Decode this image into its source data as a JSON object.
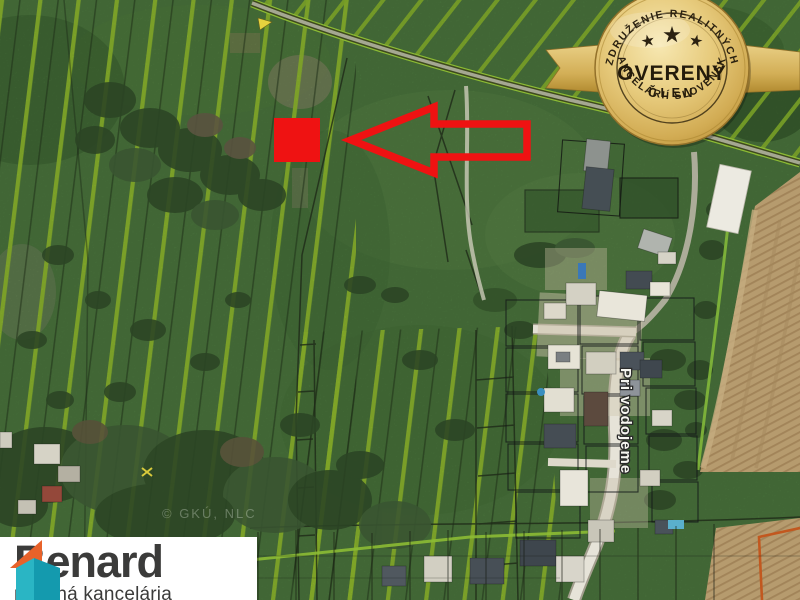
{
  "map": {
    "street_label": "Pri vodojeme",
    "watermark": "© GKÚ, NLC"
  },
  "badge": {
    "top_arc": "ZDRUŽENIE REALITNÝCH",
    "word": "OVERENÝ",
    "sub": "ČLEN",
    "bottom_arc": "KANCELÁRIÍ SLOVENSKA",
    "stars": 3
  },
  "logo": {
    "brand": "Benard",
    "tagline": "realitná kancelária"
  },
  "colors": {
    "annotation_red": "#ef1212",
    "parcel_line_green": "#98c52f",
    "badge_gold": "#d9b75f",
    "badge_text": "#2b2110",
    "logo_orange": "#e8622a",
    "logo_teal_light": "#2ab5c4",
    "logo_teal_dark": "#149aae",
    "logo_text": "#3b3b3a",
    "field_tan": "#b69b6e"
  }
}
